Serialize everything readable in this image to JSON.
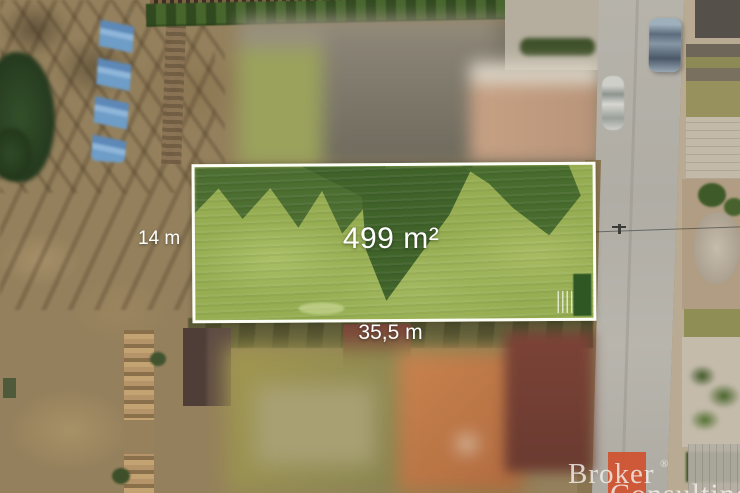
{
  "overlay": {
    "width_label": "14 m",
    "area_label": "499 m²",
    "length_label": "35,5 m"
  },
  "watermark": {
    "line1": "Broker",
    "registered": "®",
    "line2": "Consulting"
  },
  "colors": {
    "plot-green": "#96ad52",
    "plot-border": "#fdfdf8",
    "label-white": "#ffffff",
    "wm-accent": "#d0512f",
    "road-gray": "#b3b0a8"
  }
}
